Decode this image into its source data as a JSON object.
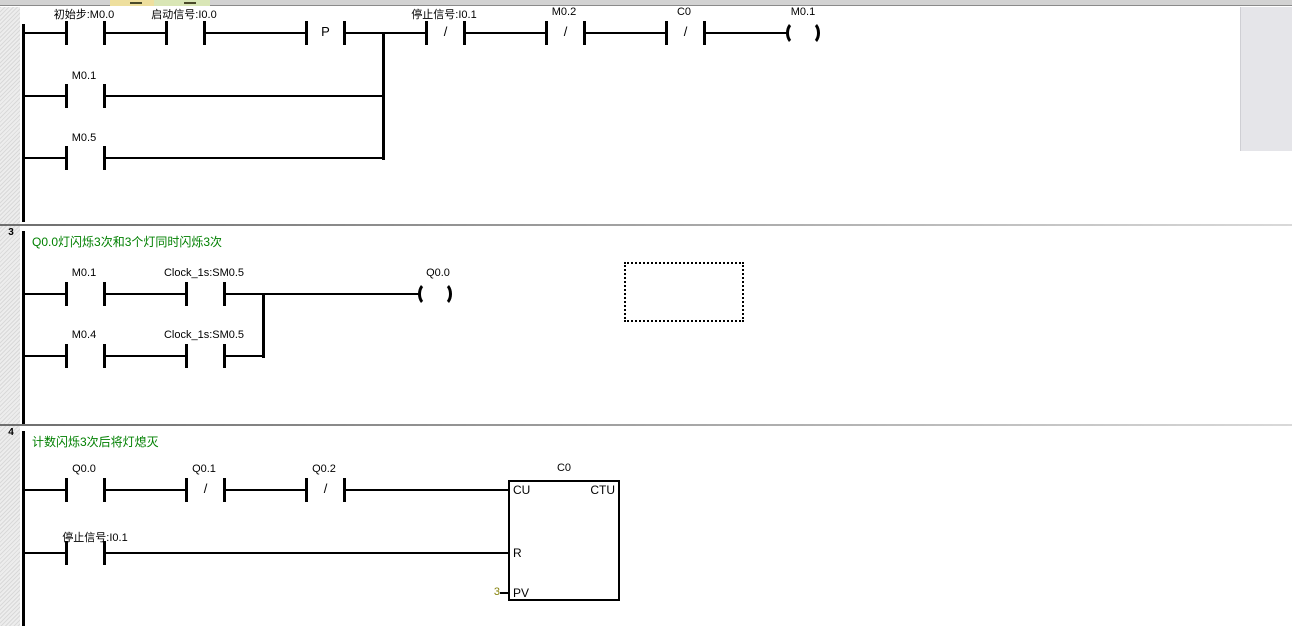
{
  "colors": {
    "comment_green": "#008000",
    "pv_olive": "#85820a",
    "accent_tan": "#eedf9e",
    "accent_green": "#d9e6b6"
  },
  "sym": {
    "nc": "/"
  },
  "n2": {
    "c1": "初始步:M0.0",
    "c2": "启动信号:I0.0",
    "p": "P",
    "c3": "停止信号:I0.1",
    "c4": "M0.2",
    "c5": "C0",
    "coil": "M0.1",
    "b1": "M0.1",
    "b2": "M0.5"
  },
  "n3": {
    "num": "3",
    "comment": "Q0.0灯闪烁3次和3个灯同时闪烁3次",
    "r1c1": "M0.1",
    "r1c2": "Clock_1s:SM0.5",
    "coil": "Q0.0",
    "r2c1": "M0.4",
    "r2c2": "Clock_1s:SM0.5"
  },
  "n4": {
    "num": "4",
    "comment": "计数闪烁3次后将灯熄灭",
    "r1c1": "Q0.0",
    "r1c2": "Q0.1",
    "r1c3": "Q0.2",
    "r2c1": "停止信号:I0.1",
    "box_title": "C0",
    "box_type": "CTU",
    "pin_cu": "CU",
    "pin_r": "R",
    "pin_pv": "PV",
    "pv_value": "3"
  }
}
